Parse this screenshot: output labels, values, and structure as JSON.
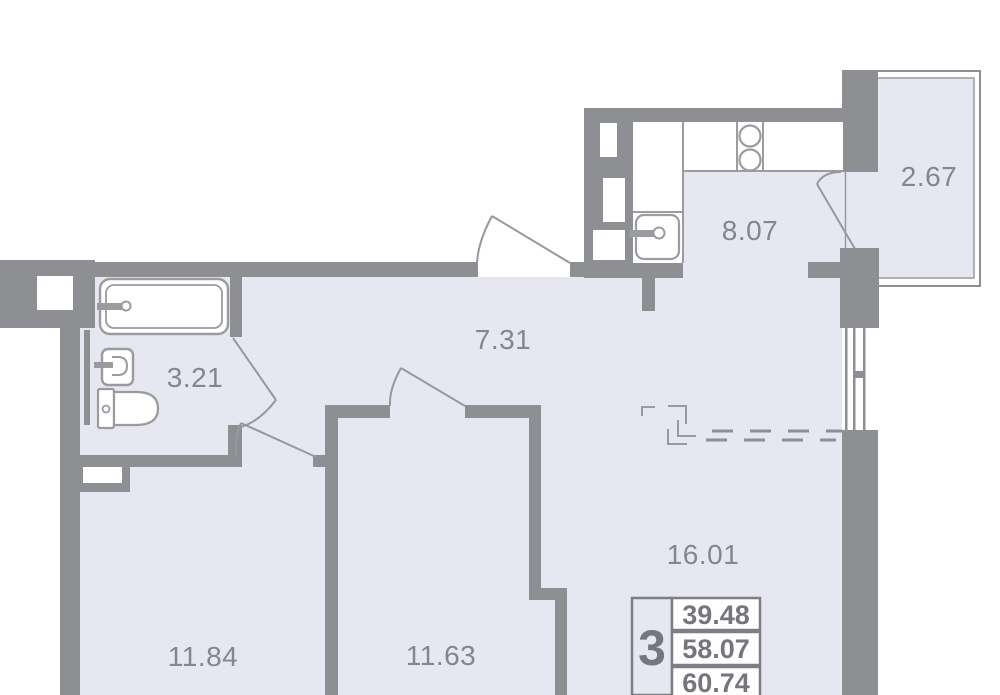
{
  "plan_type": "apartment-floor-plan",
  "rooms": {
    "balcony": {
      "label": "2.67"
    },
    "kitchen": {
      "label": "8.07"
    },
    "hallway": {
      "label": "7.31"
    },
    "bathroom": {
      "label": "3.21"
    },
    "living_room": {
      "label": "16.01"
    },
    "bedroom_left": {
      "label": "11.84"
    },
    "bedroom_center": {
      "label": "11.63"
    }
  },
  "info_stamp": {
    "room_count": "3",
    "values": [
      "39.48",
      "58.07",
      "60.74"
    ]
  },
  "fixtures": [
    "bathtub",
    "washbasin",
    "toilet",
    "stove-2-burner",
    "kitchen-sink"
  ],
  "colors": {
    "floor": "#e7e7f2",
    "wall": "#8e8f93",
    "fixture_line": "#9a9b9f",
    "room_label_text": "#85868b",
    "stamp_text": "#75767b",
    "white": "#ffffff"
  }
}
